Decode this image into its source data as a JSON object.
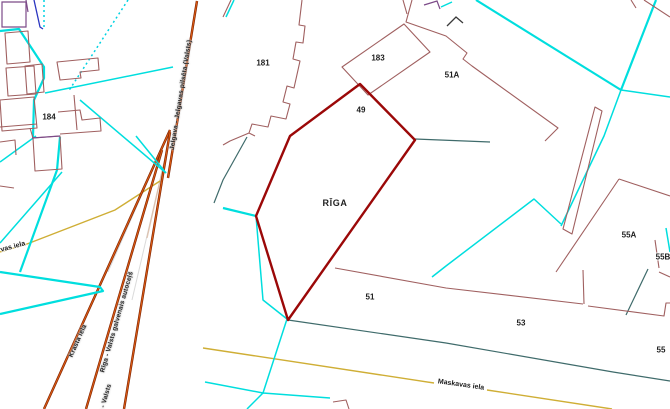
{
  "palette": {
    "background": "#ffffff",
    "boundary_cyan": "#00dede",
    "boundary_teal_dark": "#3f6b6b",
    "building_outline_maroon": "#a06060",
    "selected_parcel_red": "#9b0808",
    "railway_orange": "#dd5c12",
    "railway_casing_dark": "#7d2202",
    "street_centerline_yellow": "#cfae35",
    "detail_purple": "#7c4a88",
    "detail_blue": "#2a35c0",
    "label_text": "#1c1c1c"
  },
  "map": {
    "city_label": "RĪGA",
    "parcel_labels": [
      {
        "text": "184"
      },
      {
        "text": "181"
      },
      {
        "text": "183"
      },
      {
        "text": "49"
      },
      {
        "text": "51A"
      },
      {
        "text": "55A"
      },
      {
        "text": "55B"
      },
      {
        "text": "51"
      },
      {
        "text": "53"
      },
      {
        "text": "55"
      }
    ],
    "street_labels": [
      {
        "text": "Maskavas iela"
      },
      {
        "text": "vas iela"
      }
    ],
    "railway_labels": [
      {
        "text": "Jelgava - Jelgavas pilsēta (Valsts)"
      },
      {
        "text": "Rīga - Valsts galvenais autoceļš"
      },
      {
        "text": "Krasta iela"
      },
      {
        "text": "Rīga - Valsts"
      }
    ]
  }
}
